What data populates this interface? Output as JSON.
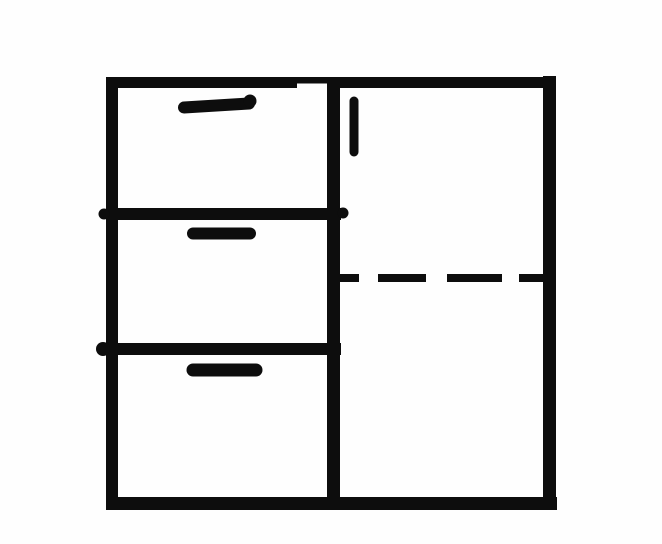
{
  "meta": {
    "description": "Hand-drawn black-and-white line sketch of a cabinet: left column of three drawers with horizontal pull handles, right side a tall door with a short vertical handle and a dashed horizontal line (hidden shelf) across the door section",
    "canvas": {
      "width": 662,
      "height": 544
    },
    "colors": {
      "ink": "#0d0d0d",
      "background": "#fefefe"
    }
  },
  "diagram": {
    "type": "line-drawing",
    "subject": "cabinet-sketch",
    "parts": {
      "frame": "outer cabinet rectangle",
      "left_column": "three stacked drawers, each with a thick rounded horizontal handle near its top",
      "right_column": "full-height door with short vertical handle at upper left; dashed horizontal line midway indicating hidden shelf/divider"
    }
  },
  "shapes": {
    "lines": [
      {
        "name": "frame-top",
        "x1": 106,
        "y1": 82.5,
        "x2": 556,
        "y2": 82.5,
        "w": 11,
        "cap": "butt"
      },
      {
        "name": "frame-left",
        "x1": 112,
        "y1": 77,
        "x2": 112,
        "y2": 510,
        "w": 12,
        "cap": "butt"
      },
      {
        "name": "frame-right",
        "x1": 549.5,
        "y1": 76,
        "x2": 549.5,
        "y2": 510,
        "w": 13,
        "cap": "butt"
      },
      {
        "name": "frame-bottom",
        "x1": 106,
        "y1": 503.5,
        "x2": 557,
        "y2": 503.5,
        "w": 13,
        "cap": "butt"
      },
      {
        "name": "center-divider",
        "x1": 333.5,
        "y1": 77,
        "x2": 333.5,
        "y2": 510,
        "w": 13,
        "cap": "butt"
      },
      {
        "name": "drawer-divider-top",
        "x1": 107,
        "y1": 214,
        "x2": 341,
        "y2": 214,
        "w": 12,
        "cap": "butt"
      },
      {
        "name": "drawer-divider-bottom",
        "x1": 107,
        "y1": 349,
        "x2": 341,
        "y2": 349,
        "w": 12,
        "cap": "butt"
      }
    ],
    "notches": [
      {
        "name": "top-border-notch",
        "x": 297,
        "y": 83.5,
        "w": 30,
        "h": 5
      }
    ],
    "handles": [
      {
        "name": "drawer-handle-1",
        "x1": 184,
        "y1": 107.5,
        "x2": 249,
        "y2": 103.5,
        "w": 12,
        "cap": "round"
      },
      {
        "name": "drawer-handle-2",
        "x1": 193,
        "y1": 233.5,
        "x2": 250,
        "y2": 233.5,
        "w": 12,
        "cap": "round"
      },
      {
        "name": "drawer-handle-3",
        "x1": 193,
        "y1": 370,
        "x2": 256,
        "y2": 370,
        "w": 13,
        "cap": "round"
      },
      {
        "name": "door-handle",
        "x1": 354,
        "y1": 101,
        "x2": 354,
        "y2": 152,
        "w": 9,
        "cap": "round"
      }
    ],
    "dashes": [
      {
        "name": "shelf-dash-1",
        "x1": 334,
        "y1": 278,
        "x2": 359,
        "y2": 278,
        "w": 8
      },
      {
        "name": "shelf-dash-2",
        "x1": 378,
        "y1": 278,
        "x2": 426,
        "y2": 278,
        "w": 8
      },
      {
        "name": "shelf-dash-3",
        "x1": 447,
        "y1": 278,
        "x2": 502,
        "y2": 278,
        "w": 8
      },
      {
        "name": "shelf-dash-4",
        "x1": 519,
        "y1": 278,
        "x2": 551,
        "y2": 278,
        "w": 8
      }
    ],
    "dots": [
      {
        "name": "ink-blot-left-upper",
        "cx": 104,
        "cy": 214,
        "r": 5.5
      },
      {
        "name": "ink-blot-left-lower",
        "cx": 103,
        "cy": 349,
        "r": 7
      },
      {
        "name": "ink-blot-divider-right",
        "cx": 343,
        "cy": 213,
        "r": 5.5
      },
      {
        "name": "ink-blot-handle-1-end",
        "cx": 250,
        "cy": 101,
        "r": 6.5
      }
    ]
  }
}
